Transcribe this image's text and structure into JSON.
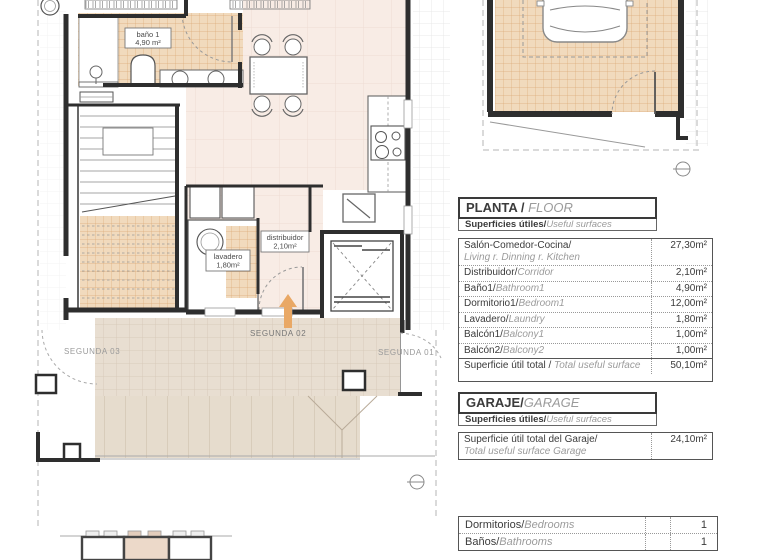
{
  "plan": {
    "rooms": {
      "bano": {
        "line1": "baño 1",
        "line2": "4,90 m²"
      },
      "lavadero": {
        "line1": "lavadero",
        "line2": "1,80m²"
      },
      "distribuidor": {
        "line1": "distribuidor",
        "line2": "2,10m²"
      }
    },
    "markers": {
      "segunda01": "SEGUNDA 01",
      "segunda02": "SEGUNDA 02",
      "segunda03": "SEGUNDA 03"
    },
    "colors": {
      "floor_pink": "#f8ece5",
      "tile_tan": "#f1dabd",
      "tile_tan_line": "#dcab79",
      "terrace": "#e8ded1",
      "arrow_orange": "#e9a865",
      "wall": "#2e2e2e"
    }
  },
  "floor_table": {
    "title_es": "PLANTA / ",
    "title_en": "FLOOR",
    "subtitle_es": "Superficies útiles/",
    "subtitle_en": "Useful surfaces",
    "rows": [
      {
        "es": "Salón-Comedor-Cocina/",
        "en": "Living r.  Dinning r.   Kitchen",
        "value": "27,30m²"
      },
      {
        "es": "Distribuidor/",
        "en": "Corridor",
        "value": "2,10m²"
      },
      {
        "es": "Baño1/",
        "en": "Bathroom1",
        "value": "4,90m²"
      },
      {
        "es": "Dormitorio1/",
        "en": "Bedroom1",
        "value": "12,00m²"
      },
      {
        "es": "Lavadero/",
        "en": "Laundry",
        "value": "1,80m²"
      },
      {
        "es": "Balcón1/",
        "en": "Balcony1",
        "value": "1,00m²"
      },
      {
        "es": "Balcón2/",
        "en": "Balcony2",
        "value": "1,00m²"
      }
    ],
    "total": {
      "es": "Superficie útil total / ",
      "en": "Total useful surface",
      "value": "50,10m²"
    }
  },
  "garage_table": {
    "title_es": "GARAJE/",
    "title_en": "GARAGE",
    "subtitle_es": "Superficies útiles/",
    "subtitle_en": "Useful surfaces",
    "row": {
      "es": "Superficie útil total del Garaje/",
      "en": "Total useful surface Garage",
      "value": "24,10m²"
    }
  },
  "counts_table": {
    "rows": [
      {
        "es": "Dormitorios/",
        "en": "Bedrooms",
        "value": "1"
      },
      {
        "es": "Baños/",
        "en": "Bathrooms",
        "value": "1"
      }
    ]
  }
}
